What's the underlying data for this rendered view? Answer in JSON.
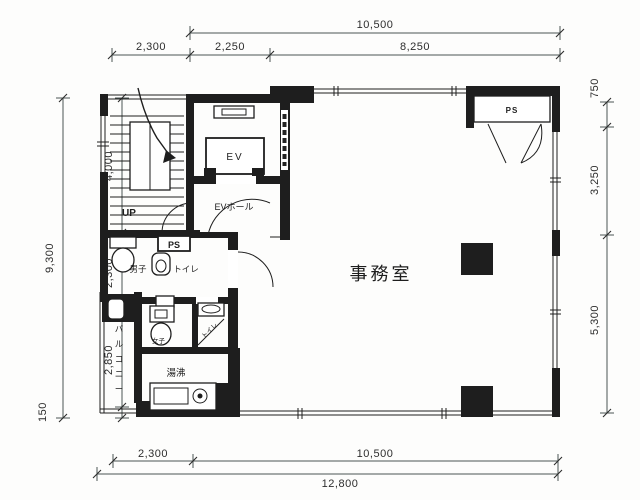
{
  "meta": {
    "drawing_type": "building floor plan (scanned architectural drawing)"
  },
  "colors": {
    "ink": "#1e1e1e",
    "dim_line": "#4a5553",
    "dim_text": "#2d2d2d",
    "paper": "#ffffff"
  },
  "labels": {
    "office": "事務室",
    "elevator": "EV",
    "ev_hall": "EVホール",
    "stairs_up": "UP",
    "mens_toilet_1": "男子",
    "mens_toilet_2": "トイレ",
    "ps_shaft": "PS",
    "ps_closet": "PS",
    "womens_left": "女子",
    "womens_right": "トイレ",
    "kitchenette": "湯沸",
    "balcony": "バルコニー"
  },
  "dimensions": {
    "top_overall": "10,500",
    "top_segments": [
      "2,300",
      "2,250",
      "8,250"
    ],
    "left_overall": "9,300",
    "left_segments": [
      "4,000",
      "2,300",
      "2,850",
      "150"
    ],
    "right_segments": [
      "750",
      "3,250",
      "5,300"
    ],
    "bottom_segments": [
      "2,300",
      "10,500"
    ],
    "bottom_overall": "12,800"
  }
}
